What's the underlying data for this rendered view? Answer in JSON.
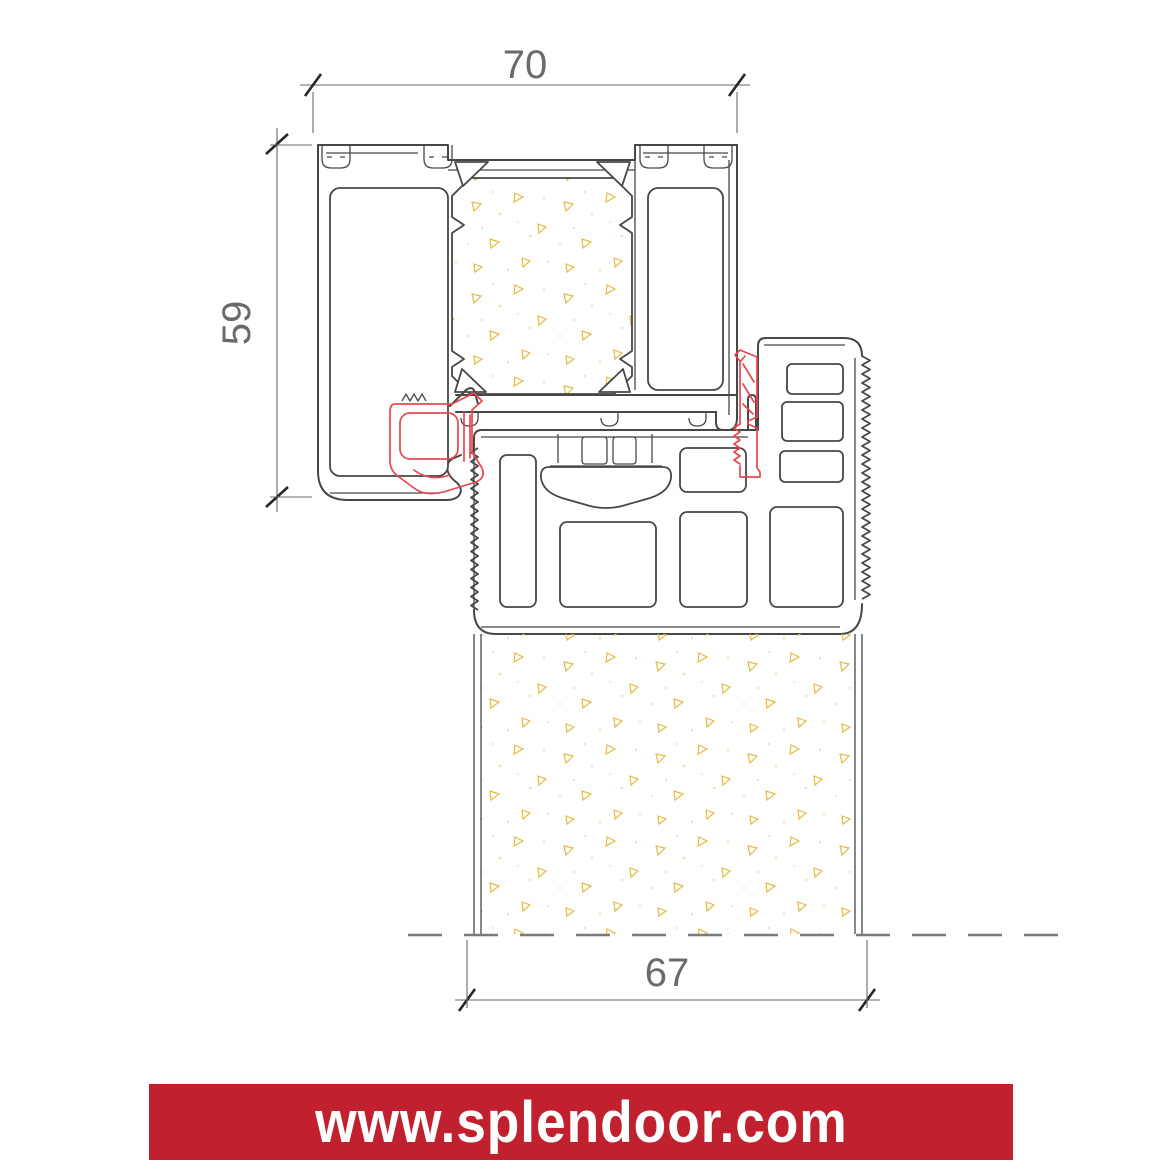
{
  "drawing": {
    "title": "door-threshold-cross-section",
    "dimensions": {
      "top_width": "70",
      "left_height": "59",
      "bottom_width": "67"
    },
    "colors": {
      "outline": "#474747",
      "dimension": "#6a6a6a",
      "gasket-red": "#e8474e",
      "speckle-yellow": "#e2bd45",
      "banner-red": "#c1202e",
      "banner-text": "#ffffff"
    }
  },
  "footer": {
    "url": "www.splendoor.com"
  }
}
